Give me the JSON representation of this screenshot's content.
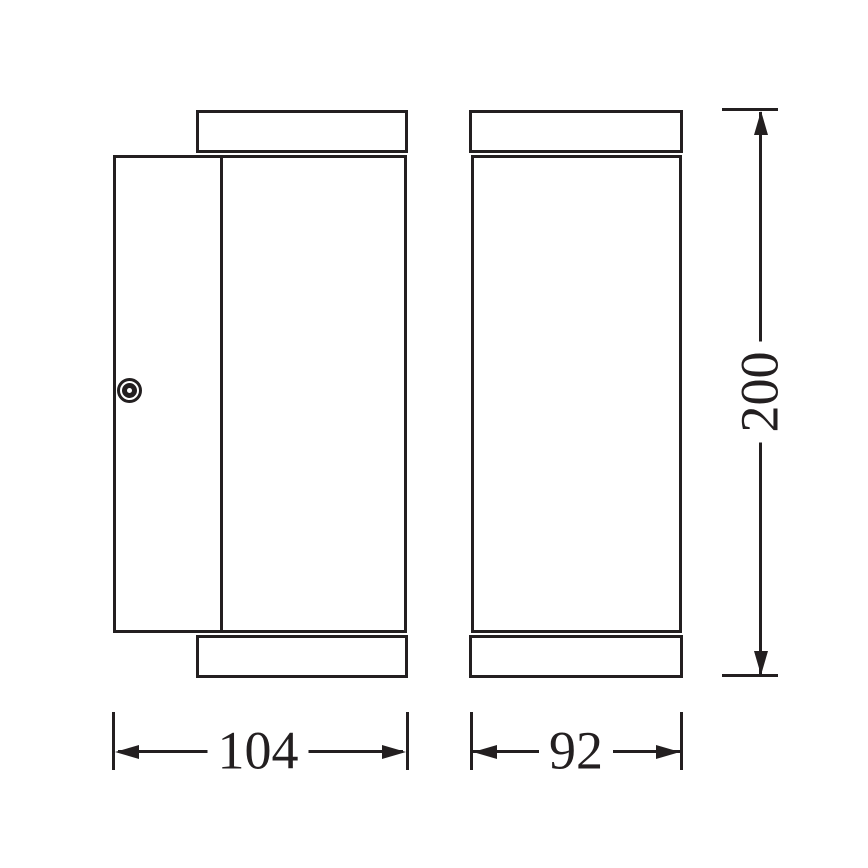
{
  "drawing": {
    "colors": {
      "line": "#231f20",
      "background": "#ffffff"
    },
    "dimensions": {
      "side_width": "104",
      "front_width": "92",
      "height": "200"
    }
  }
}
